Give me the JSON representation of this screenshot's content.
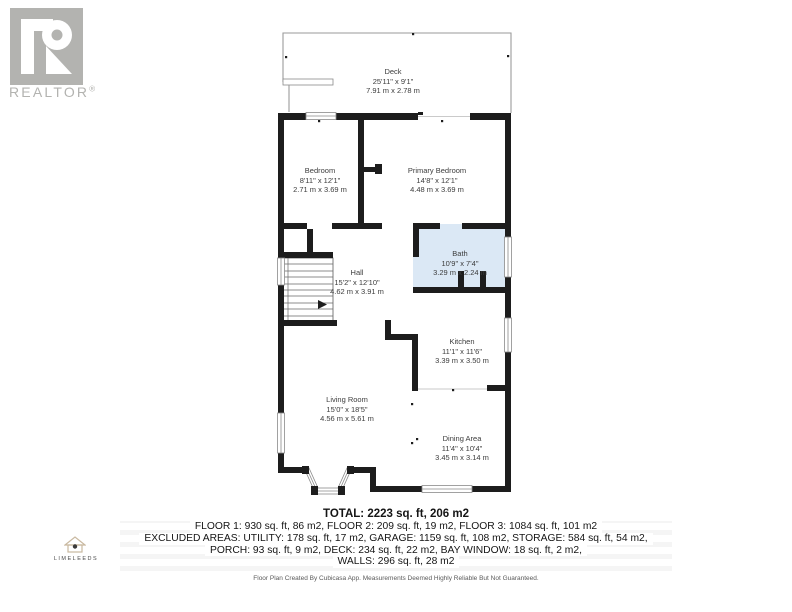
{
  "branding": {
    "realtor_logo_text": "REALTOR",
    "realtor_reg_mark": "®",
    "company_logo_text": "LIMELEEDS"
  },
  "rooms": [
    {
      "name": "Deck",
      "imperial": "25'11\" x 9'1\"",
      "metric": "7.91 m x 2.78 m"
    },
    {
      "name": "Bedroom",
      "imperial": "8'11\" x 12'1\"",
      "metric": "2.71 m x 3.69 m"
    },
    {
      "name": "Primary Bedroom",
      "imperial": "14'8\" x 12'1\"",
      "metric": "4.48 m x 3.69 m"
    },
    {
      "name": "Bath",
      "imperial": "10'9\" x 7'4\"",
      "metric": "3.29 m x 2.24 m"
    },
    {
      "name": "Hall",
      "imperial": "15'2\" x 12'10\"",
      "metric": "4.62 m x 3.91 m"
    },
    {
      "name": "Kitchen",
      "imperial": "11'1\" x 11'6\"",
      "metric": "3.39 m x 3.50 m"
    },
    {
      "name": "Living Room",
      "imperial": "15'0\" x 18'5\"",
      "metric": "4.56 m x 5.61 m"
    },
    {
      "name": "Dining Area",
      "imperial": "11'4\" x 10'4\"",
      "metric": "3.45 m x 3.14 m"
    }
  ],
  "summary": {
    "total": "TOTAL: 2223 sq. ft, 206 m2",
    "line1": "FLOOR 1: 930 sq. ft, 86 m2, FLOOR 2: 209 sq. ft, 19 m2, FLOOR 3: 1084 sq. ft, 101 m2",
    "line2": "EXCLUDED AREAS: UTILITY: 178 sq. ft, 17 m2, GARAGE: 1159 sq. ft, 108 m2, STORAGE: 584 sq. ft, 54 m2,",
    "line3": "PORCH: 93 sq. ft, 9 m2, DECK: 234 sq. ft, 22 m2, BAY WINDOW: 18 sq. ft, 2 m2,",
    "line4": "WALLS: 296 sq. ft, 28 m2"
  },
  "disclaimer": "Floor Plan Created By Cubicasa App. Measurements Deemed Highly Reliable But Not Guaranteed.",
  "colors": {
    "wall": "#1d1d1d",
    "bath_highlight": "#dbe8f5",
    "logo_gray": "#b3b3b0",
    "house_icon_tan": "#c9b9a0"
  }
}
